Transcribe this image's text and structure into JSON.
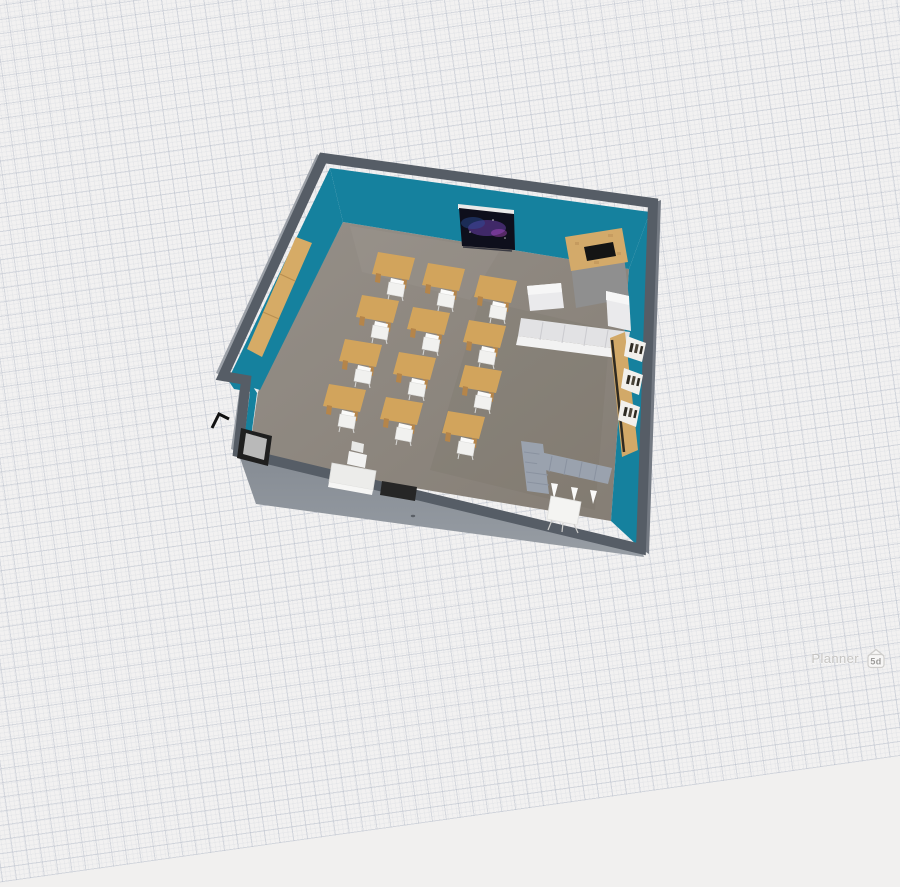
{
  "watermark": {
    "brand": "Planner",
    "badge": "5d"
  },
  "palette": {
    "background": "#f2f1f1",
    "grid_line": "#b2b9c6",
    "wall_teal": "#15819e",
    "wall_top": "#565d66",
    "wall_outer_right": "#747a83",
    "wall_outer_left": "#9ba0a7",
    "wall_outer_bottom": "#8d939a",
    "floor_light": "#958f88",
    "floor_dark": "#857e75",
    "desk_wood": "#d2a45c",
    "desk_leg": "#b5854a",
    "chair_white": "#f4f4f2",
    "sofa_light": "#eaeaec",
    "sofa_seat": "#e2e2e4",
    "bookshelf_wood": "#d2a968",
    "shelf_white": "#f2f0ec",
    "book_dark": "#2e2a22",
    "fireplace_sand": "#d3aa6a",
    "fireplace_opening": "#141414",
    "fireplace_base": "#8f8f8f",
    "tv_screen": "#0e0f1c",
    "tv_nebula_purple": "#6a3fa8",
    "tv_nebula_blue": "#2c4f9e",
    "tv_nebula_magenta": "#c04fd8",
    "ldesk_gray": "#9aa2ae",
    "board_frame": "#1f1f1f",
    "board_face": "#b9b9b9",
    "cabinet_wood": "#d6ab66",
    "watermark_text": "#c6c5c3"
  },
  "scene": {
    "desk_count": 12,
    "desks": [
      [
        378,
        252
      ],
      [
        428,
        263
      ],
      [
        480,
        275
      ],
      [
        362,
        295
      ],
      [
        413,
        307
      ],
      [
        469,
        320
      ],
      [
        345,
        339
      ],
      [
        399,
        352
      ],
      [
        465,
        365
      ],
      [
        329,
        384
      ],
      [
        386,
        397
      ],
      [
        448,
        411
      ]
    ]
  }
}
